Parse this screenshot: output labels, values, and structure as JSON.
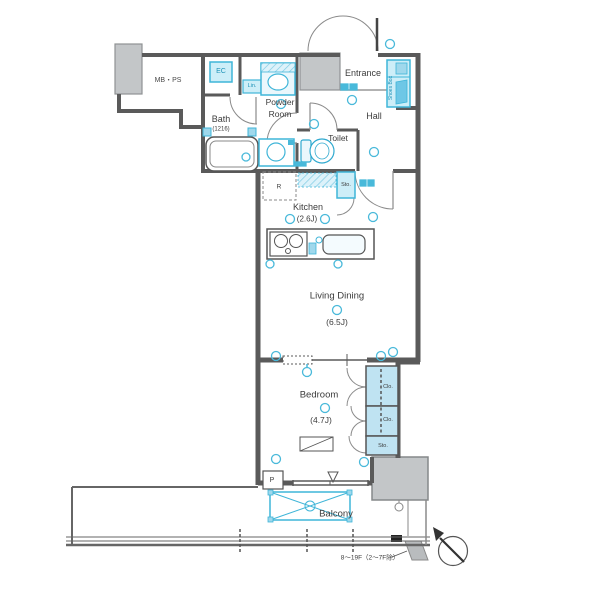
{
  "title": "apartment-floor-plan",
  "colors": {
    "wall": "#5a5a5a",
    "fixture_accent": "#3fb5d8",
    "fixture_fill": "#cdeef8",
    "closet_fill": "#bfe3f2",
    "gray_block": "#c3c6c8"
  },
  "rooms": {
    "mbps": {
      "label": "MB・PS"
    },
    "ec": {
      "label": "EC"
    },
    "linen": {
      "label": "Lin."
    },
    "powder": {
      "label_line1": "Powder",
      "label_line2": "Room"
    },
    "entrance": {
      "label": "Entrance"
    },
    "shoes_box": {
      "label": "Shoes Box"
    },
    "hall": {
      "label": "Hall"
    },
    "bath": {
      "label": "Bath",
      "size": "(1216)"
    },
    "toilet": {
      "label": "Toilet"
    },
    "refrigerator": {
      "label": "R"
    },
    "storage_hall": {
      "label": "Sto."
    },
    "kitchen": {
      "label": "Kitchen",
      "size": "(2.6J)"
    },
    "living_dining": {
      "label": "Living Dining",
      "size": "(6.5J)"
    },
    "bedroom": {
      "label": "Bedroom",
      "size": "(4.7J)"
    },
    "closet_a": {
      "label": "Clo."
    },
    "closet_b": {
      "label": "Clo."
    },
    "storage_bedroom": {
      "label": "Sto."
    },
    "pipe_shaft": {
      "label": "P"
    },
    "balcony": {
      "label": "Balcony"
    }
  },
  "annotations": {
    "floor_note": "8〜19F（2〜7F除）"
  }
}
